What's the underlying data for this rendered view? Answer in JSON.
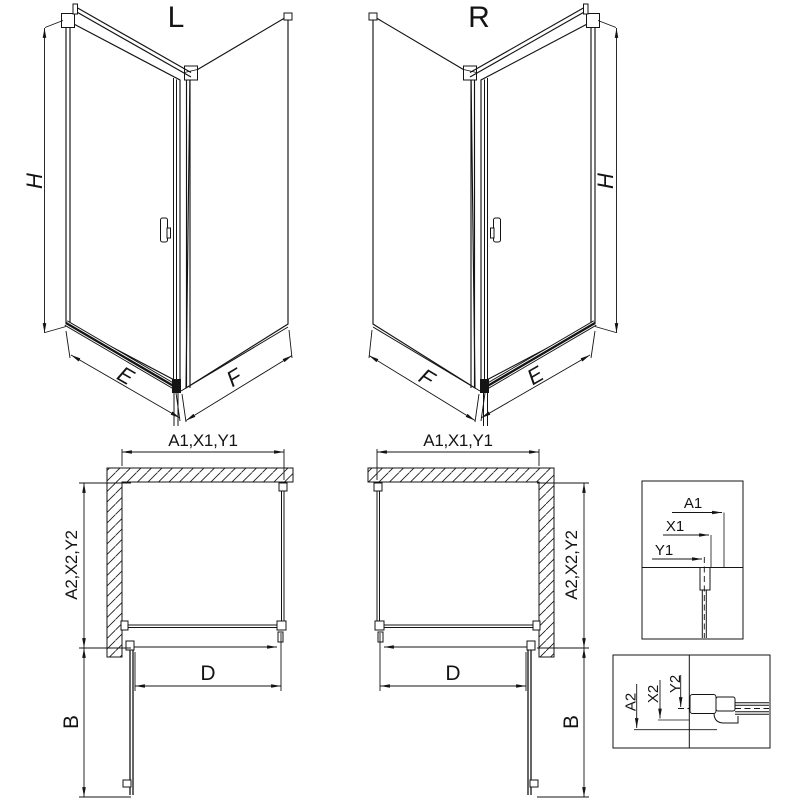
{
  "colors": {
    "line": "#141414",
    "background": "#ffffff"
  },
  "views": {
    "perspective_left": {
      "title": "L",
      "dims": {
        "height": "H",
        "front": "E",
        "side": "F"
      }
    },
    "perspective_right": {
      "title": "R",
      "dims": {
        "height": "H",
        "front": "E",
        "side": "F"
      }
    },
    "plan_left": {
      "dims": {
        "top": "A1,X1,Y1",
        "left": "A2,X2,Y2",
        "opening": "D",
        "door": "B"
      }
    },
    "plan_right": {
      "dims": {
        "top": "A1,X1,Y1",
        "right": "A2,X2,Y2",
        "opening": "D",
        "door": "B"
      }
    },
    "detail_wall_profile_plan": {
      "dims": [
        "A1",
        "X1",
        "Y1"
      ]
    },
    "detail_wall_profile_side": {
      "dims": [
        "A2",
        "X2",
        "Y2"
      ]
    }
  }
}
